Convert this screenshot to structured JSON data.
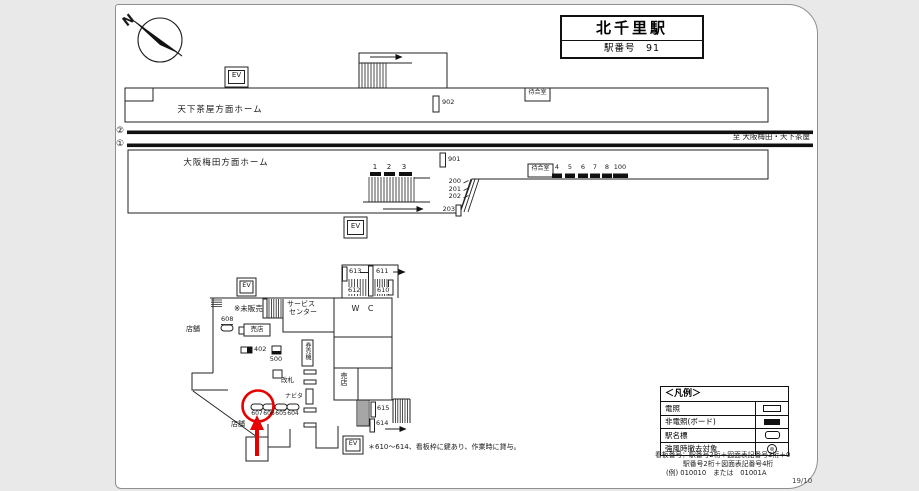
{
  "page": {
    "sheet_code": "19/10"
  },
  "title": {
    "station_name": "北千里駅",
    "station_number": "駅番号　91"
  },
  "compass": {
    "north": "N"
  },
  "upper_platform": {
    "label": "天下茶屋方面ホーム",
    "ev": "EV",
    "sign_902": "902",
    "waiting_room": "待合室"
  },
  "tracks": {
    "track_2": "②",
    "track_1": "①",
    "direction_note": "至 大阪梅田・天下茶屋"
  },
  "lower_platform": {
    "label": "大阪梅田方面ホーム",
    "ev": "EV",
    "sign_901": "901",
    "waiting_room": "待合室",
    "stair_signs": [
      "1",
      "2",
      "3"
    ],
    "escalator_signs": [
      "200",
      "201",
      "202"
    ],
    "sign_203": "203",
    "wall_signs": [
      "4",
      "5",
      "6",
      "7",
      "8",
      "100"
    ]
  },
  "concourse": {
    "ev_north": "EV",
    "ev_south": "EV",
    "unsold_note": "※未販売",
    "service_center_line1": "サービス",
    "service_center_line2": "センター",
    "sign_608": "608",
    "kiosk_box": "売店",
    "kiosk_vertical": "売店",
    "store_label_left": "店舗",
    "store_label_bottom": "店舗",
    "sign_402": "402",
    "sign_500": "500",
    "ticket_machine": "券売機",
    "ticket_gate": "改札",
    "navita": "ナビタ",
    "restroom": "W C",
    "stair_signs_top": [
      "613",
      "611",
      "612",
      "610"
    ],
    "stair_signs_bottom": [
      "615",
      "614"
    ],
    "gate_signs": [
      "607",
      "606",
      "605",
      "604"
    ],
    "footnote": "＊610～614、看板枠に鍵あり、作業時に貸与。"
  },
  "legend": {
    "title": "＜凡例＞",
    "rows": [
      {
        "label": "電照"
      },
      {
        "label": "非電照(ボード)"
      },
      {
        "label": "駅名標"
      },
      {
        "label": "強風時撤去対象"
      }
    ]
  },
  "footer": {
    "line1": "看板番号：駅番号2桁＋図面表記番号3桁＋0",
    "line2": "駅番号2桁＋図面表記番号4桁",
    "line3": "(例) 010010　または　01001A"
  }
}
